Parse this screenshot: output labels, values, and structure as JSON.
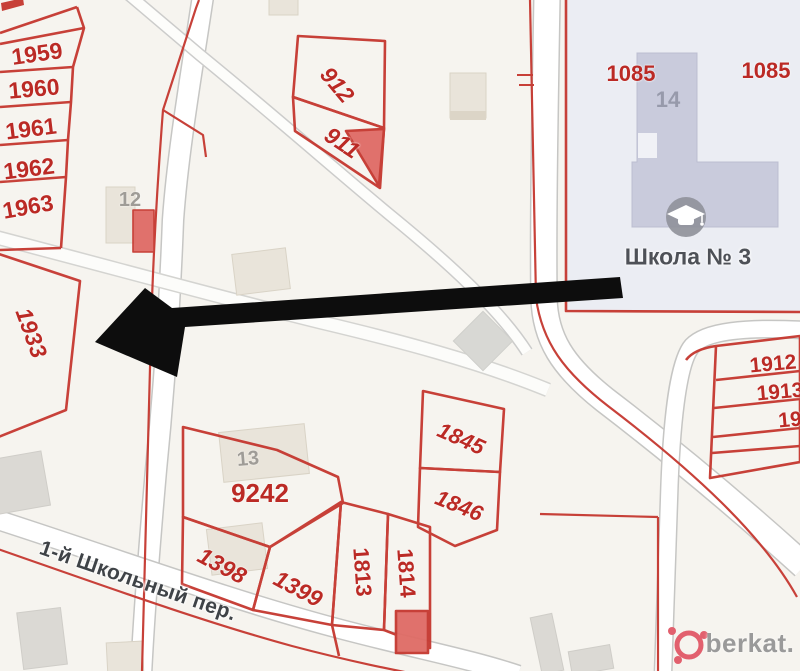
{
  "parcels": {
    "p1959": "1959",
    "p1960": "1960",
    "p1961": "1961",
    "p1962": "1962",
    "p1963": "1963",
    "p912": "912",
    "p911": "911",
    "p1085_left": "1085",
    "p1085_right": "1085",
    "p1933": "1933",
    "p9242": "9242",
    "p1398": "1398",
    "p1399": "1399",
    "p1813": "1813",
    "p1814": "1814",
    "p1845": "1845",
    "p1846": "1846",
    "p1912": "1912",
    "p1913": "1913",
    "p19_cut": "19"
  },
  "buildings": {
    "n12": "12",
    "n13": "13",
    "n14": "14"
  },
  "school": {
    "name": "Школа № 3",
    "icon": "graduation-cap-icon"
  },
  "street": {
    "name": "1-й Школьный пер."
  },
  "annotation": {
    "arrow_icon": "left-arrow-icon",
    "points_to_parcel": "1933"
  },
  "watermark": {
    "logo_icon": "berkat-logo-icon",
    "text": "berkat."
  },
  "colors": {
    "background": "#f6f4ef",
    "cadastral_red": "#c5372f",
    "label_red": "#bb2a25",
    "building_red_fill": "#df6b65",
    "road_white": "#ffffff",
    "road_edge_gray": "#c6c6c4",
    "building_beige": "#e9e4da",
    "building_gray": "#dbd9d4",
    "school_block_fill": "#ebedf3",
    "school_building_fill": "#c9cbdc",
    "gray_building_label": "#9f9c97",
    "school_text": "#4e5157",
    "street_text": "#3f4347",
    "arrow_black": "#0d0d0d",
    "watermark_pink": "#e2606e",
    "watermark_text_gray": "#9a9a9a"
  }
}
